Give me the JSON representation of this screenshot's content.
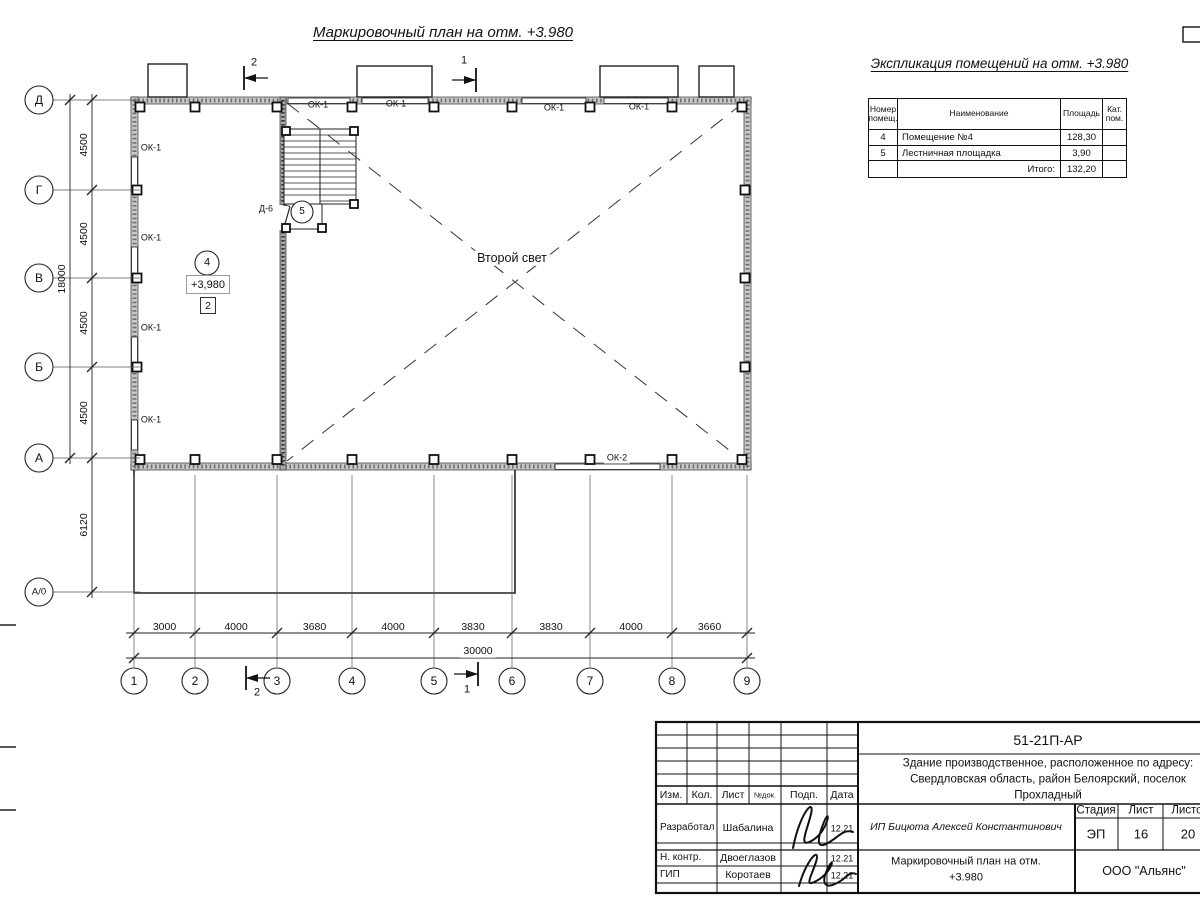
{
  "page": {
    "main_title": "Маркировочный план на отм. +3.980",
    "expl_title": "Экспликация помещений на отм. +3.980"
  },
  "expl_table": {
    "col_headers": [
      "Номер помещ.",
      "Наименование",
      "Площадь",
      "Кат. пом."
    ],
    "rows": [
      {
        "num": "4",
        "name": "Помещение №4",
        "area": "128,30",
        "cat": ""
      },
      {
        "num": "5",
        "name": "Лестничная площадка",
        "area": "3,90",
        "cat": ""
      }
    ],
    "total_label": "Итого:",
    "total_value": "132,20"
  },
  "plan": {
    "axis_rows": [
      "Д",
      "Г",
      "В",
      "Б",
      "А",
      "А/0"
    ],
    "axis_cols": [
      "1",
      "2",
      "3",
      "4",
      "5",
      "6",
      "7",
      "8",
      "9"
    ],
    "dim_left_segments": [
      "4500",
      "4500",
      "4500",
      "4500"
    ],
    "dim_left_annex": "6120",
    "dim_left_total": "18000",
    "dim_bottom_segments": [
      "3000",
      "4000",
      "3680",
      "4000",
      "3830",
      "3830",
      "4000",
      "3660"
    ],
    "dim_bottom_total": "30000",
    "window_label_1": "ОК-1",
    "window_label_2": "ОК-2",
    "door_label": "Д-6",
    "room4_number": "4",
    "room5_number": "5",
    "elevation_mark": "+3,980",
    "zone_mark": "2",
    "second_light": "Второй свет",
    "section_mark_1": "1",
    "section_mark_2": "2"
  },
  "title_block": {
    "doc_number": "51-21П-АР",
    "project_line1": "Здание производственное, расположенное по адресу:",
    "project_line2": "Свердловская область, район Белоярский, поселок",
    "project_line3": "Прохладный",
    "client": "ИП Бицюта Алексей Константинович",
    "table_headers": [
      "Изм.",
      "Кол.",
      "Лист",
      "№док.",
      "Подп.",
      "Дата"
    ],
    "signers": [
      {
        "role": "Разработал",
        "name": "Шабалина",
        "date": "12.21"
      },
      {
        "role": "Н. контр.",
        "name": "Двоеглазов",
        "date": "12.21"
      },
      {
        "role": "ГИП",
        "name": "Коротаев",
        "date": "12.21"
      }
    ],
    "stage_headers": [
      "Стадия",
      "Лист",
      "Листов"
    ],
    "stage": "ЭП",
    "sheet": "16",
    "sheets": "20",
    "sheet_title_line1": "Маркировочный план на отм.",
    "sheet_title_line2": "+3.980",
    "company": "ООО \"Альянс\""
  }
}
